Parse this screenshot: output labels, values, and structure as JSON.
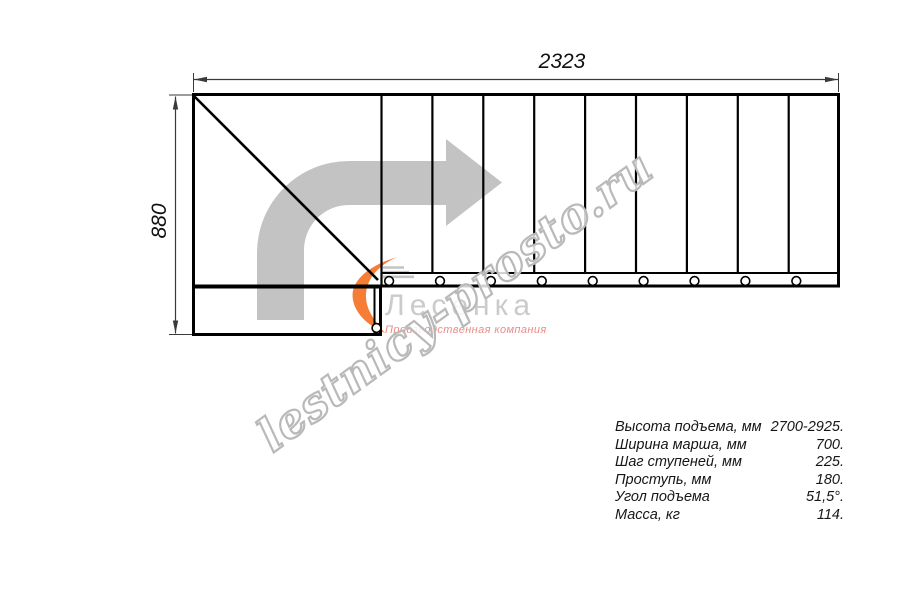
{
  "page": {
    "background": "#ffffff"
  },
  "drawing": {
    "width_dimension": "2323",
    "height_dimension": "880",
    "line_color": "#000000",
    "dimension_color": "#3a3a3a",
    "direction_arrow_color": "#c3c3c3",
    "tread_count_straight_flight": 9,
    "baluster_marker_count": 10
  },
  "watermark": {
    "site_text": "lestnicy-prosto.ru",
    "outline_color": "#b9b9b9"
  },
  "logo": {
    "company": "Лесенка",
    "tagline": "Производственная компания",
    "swoosh_color": "#f57d36",
    "steps_color": "#c4c4c4",
    "company_color": "#cbcbcb",
    "tagline_color": "#e98b8b"
  },
  "specs": {
    "rows": [
      {
        "label": "Высота подъема, мм",
        "value": "2700-2925."
      },
      {
        "label": "Ширина марша, мм",
        "value": "700."
      },
      {
        "label": "Шаг ступеней, мм",
        "value": "225."
      },
      {
        "label": "Проступь, мм",
        "value": "180."
      },
      {
        "label": "Угол подъема",
        "value": "51,5°."
      },
      {
        "label": "Масса, кг",
        "value": "114."
      }
    ]
  }
}
